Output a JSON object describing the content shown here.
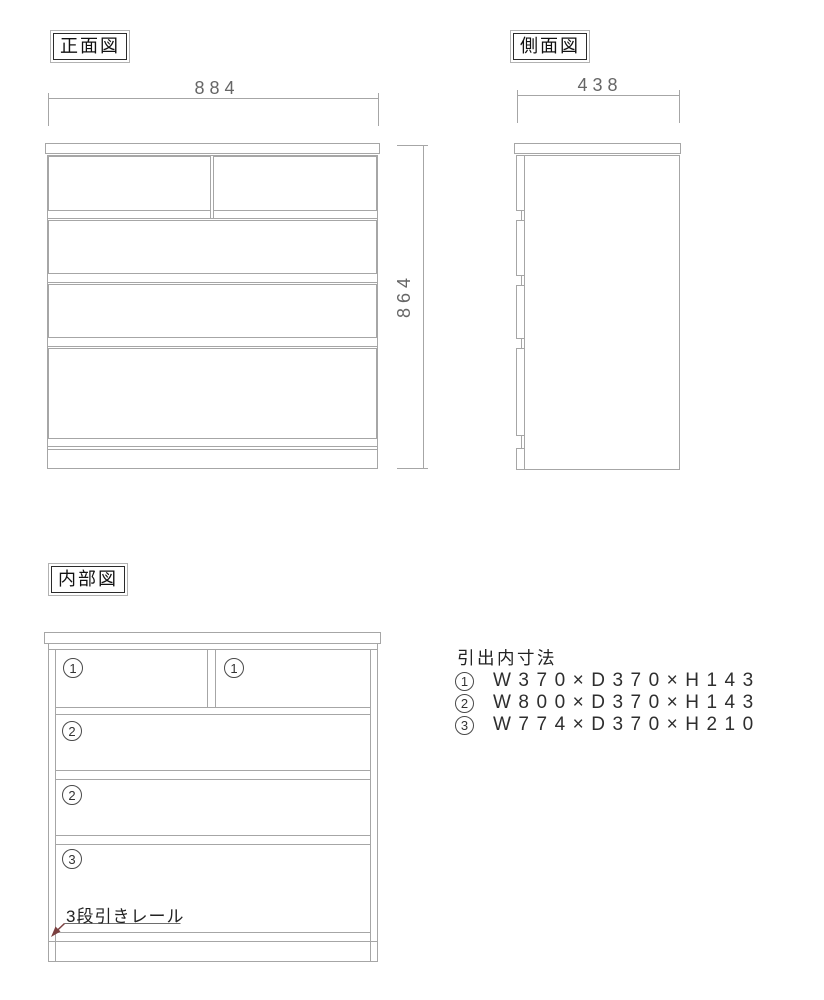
{
  "page": {
    "background": "#ffffff"
  },
  "colors": {
    "drawing_line": "#a6a6a6",
    "dimension_text": "#666666",
    "label_text": "#111111",
    "leader_line": "#7b4040"
  },
  "front_view": {
    "label": "正面図",
    "width_dim": "884",
    "height_dim": "864"
  },
  "side_view": {
    "label": "側面図",
    "width_dim": "438"
  },
  "internal_view": {
    "label": "内部図",
    "compartments": [
      {
        "num": "1",
        "position": "top-left"
      },
      {
        "num": "1",
        "position": "top-right"
      },
      {
        "num": "2",
        "position": "second-row"
      },
      {
        "num": "2",
        "position": "third-row"
      },
      {
        "num": "3",
        "position": "bottom-row"
      }
    ],
    "rail_note": "3段引きレール"
  },
  "specs": {
    "title": "引出内寸法",
    "items": [
      {
        "num": "1",
        "dims": "W370×D370×H143"
      },
      {
        "num": "2",
        "dims": "W800×D370×H143"
      },
      {
        "num": "3",
        "dims": "W774×D370×H210"
      }
    ]
  }
}
